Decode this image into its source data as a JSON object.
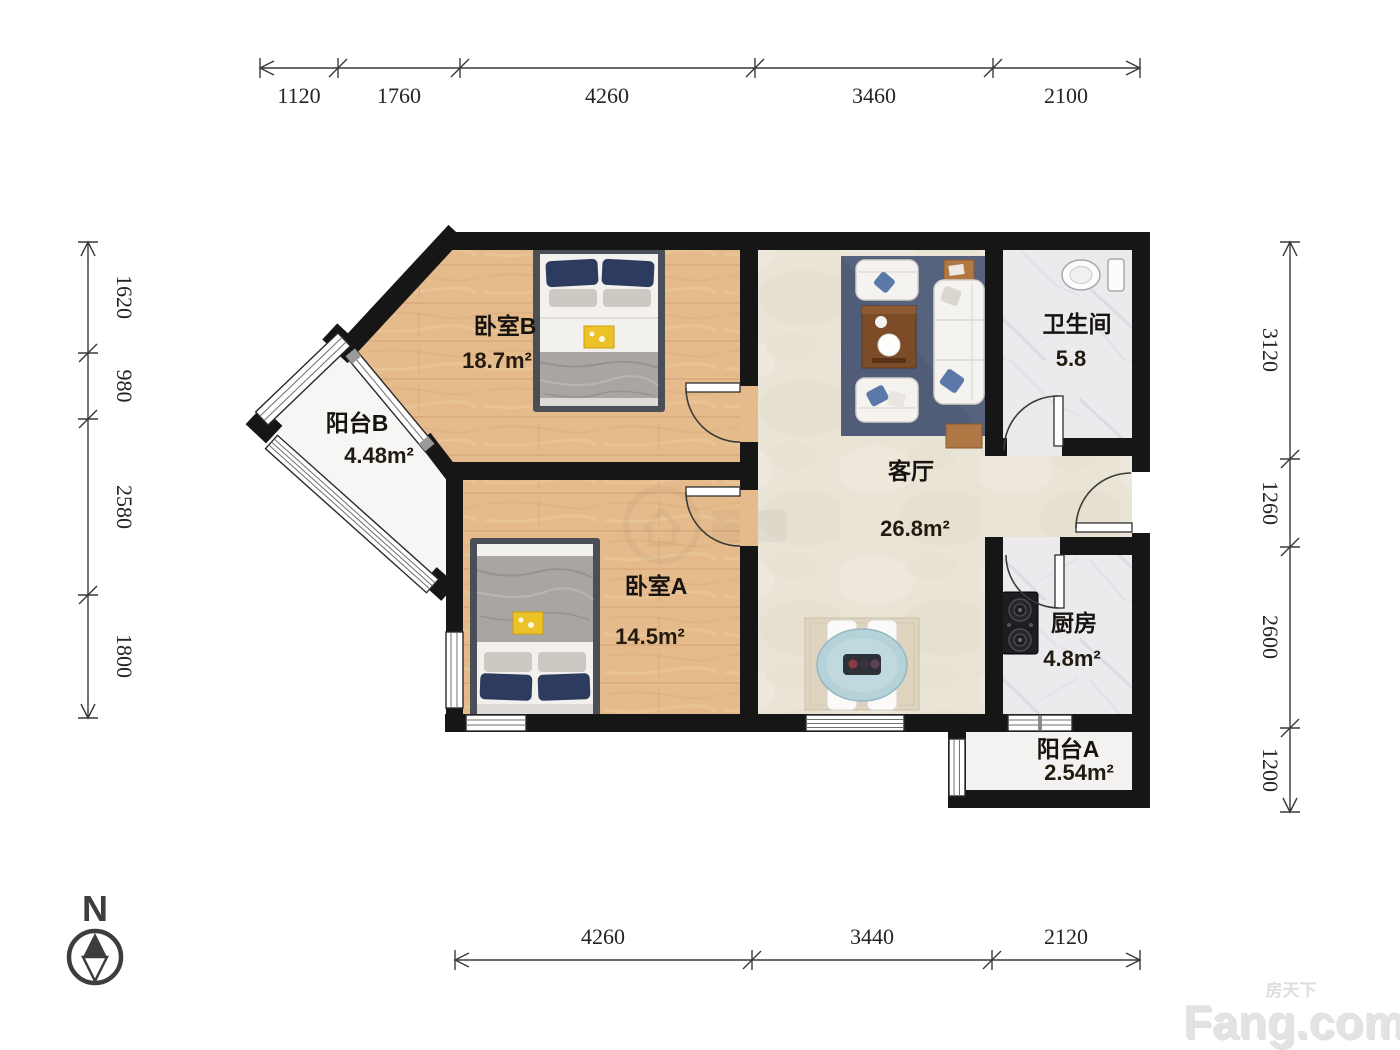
{
  "branding": {
    "logo_text": "Fang.com",
    "logo_cjk": "房天下"
  },
  "compass": {
    "north_label": "N"
  },
  "rooms": {
    "bedroom_b": {
      "name": "卧室B",
      "area": "18.7m²"
    },
    "balcony_b": {
      "name": "阳台B",
      "area": "4.48m²"
    },
    "bedroom_a": {
      "name": "卧室A",
      "area": "14.5m²"
    },
    "living_room": {
      "name": "客厅",
      "area": "26.8m²"
    },
    "bathroom": {
      "name": "卫生间",
      "area": "5.8"
    },
    "kitchen": {
      "name": "厨房",
      "area": "4.8m²"
    },
    "balcony_a": {
      "name": "阳台A",
      "area": "2.54m²"
    }
  },
  "dimensions_mm": {
    "top": [
      "1120",
      "1760",
      "4260",
      "3460",
      "2100"
    ],
    "left": [
      "1620",
      "980",
      "2580",
      "1800"
    ],
    "right": [
      "3120",
      "1260",
      "2600",
      "1200"
    ],
    "bottom": [
      "4260",
      "3440",
      "2120"
    ]
  },
  "colors": {
    "wall": "#161616",
    "wood_floor": "#e5bb8b",
    "tile_floor": "#eae4d7",
    "marble_floor": "#ebebee",
    "balcony_floor": "#f6f6f5",
    "rug_blue": "#57627e",
    "table_wood": "#7c4b28",
    "accent_yellow": "#ecc227",
    "pillow_navy": "#2c3b5e"
  }
}
